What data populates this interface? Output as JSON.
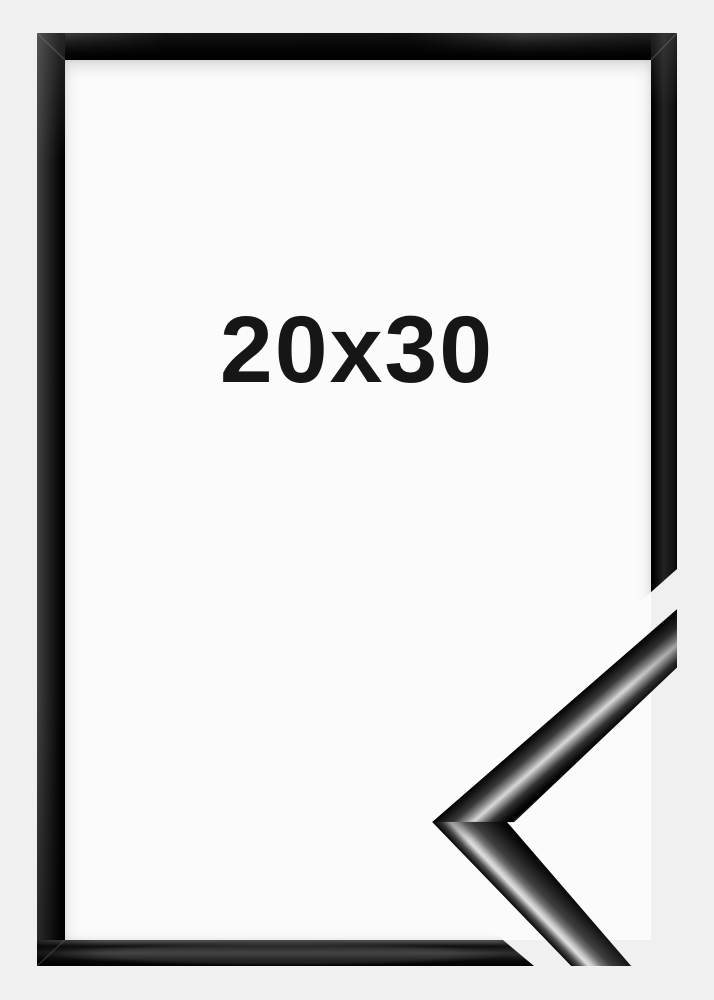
{
  "image": {
    "type": "product-photo",
    "subject": "black glossy picture frame with cut-away corner profile sample",
    "size_label": "20x30"
  },
  "colors": {
    "background": "#f0f0f0",
    "frame_opening": "#fbfbfb",
    "frame": "#000000",
    "gloss_highlight": "#d9d9d9",
    "label_text": "#161616"
  }
}
